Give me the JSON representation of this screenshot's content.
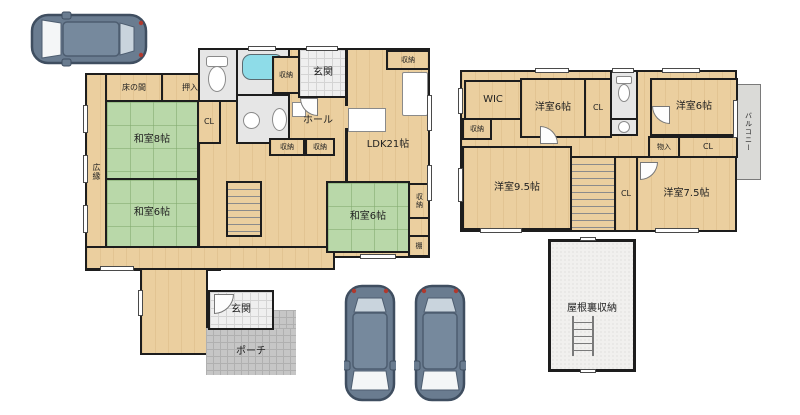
{
  "plan_type": "residential-floor-plan",
  "colors": {
    "wood_floor": "#ebcf9f",
    "tatami": "#b9d8a9",
    "wall": "#1d1d1d",
    "entry_tile": "#efefef",
    "porch_tile": "#c6c6c6",
    "sanitary_floor": "#e6e6e6",
    "balcony": "#dadad7",
    "attic_floor": "#f1f0ee",
    "bathtub": "#8edce8",
    "car_body": "#6a7c90"
  },
  "floor1": {
    "hiroen": "広縁",
    "tokonoma": "床の間",
    "oshiire": "押入",
    "washitsu8": "和室8帖",
    "cl": "CL",
    "washitsu6a": "和室6帖",
    "shuno_bath": "収納",
    "genkan_top": "玄関",
    "hall": "ホール",
    "shuno_hall_a": "収納",
    "shuno_hall_b": "収納",
    "ldk": "LDK21帖",
    "shuno_ldk": "収納",
    "washitsu6b": "和室6帖",
    "shuno_washitsu": "収納",
    "tana": "棚",
    "genkan_bottom": "玄関",
    "porch": "ポーチ"
  },
  "floor2": {
    "wic": "WIC",
    "shuno": "収納",
    "youshitsu6a": "洋室6帖",
    "cl_a": "CL",
    "youshitsu6b": "洋室6帖",
    "balcony": "バルコニー",
    "monoire": "物入",
    "cl_b": "CL",
    "youshitsu95": "洋室9.5帖",
    "cl_c": "CL",
    "youshitsu75": "洋室7.5帖"
  },
  "attic": {
    "label": "屋根裏収納"
  }
}
